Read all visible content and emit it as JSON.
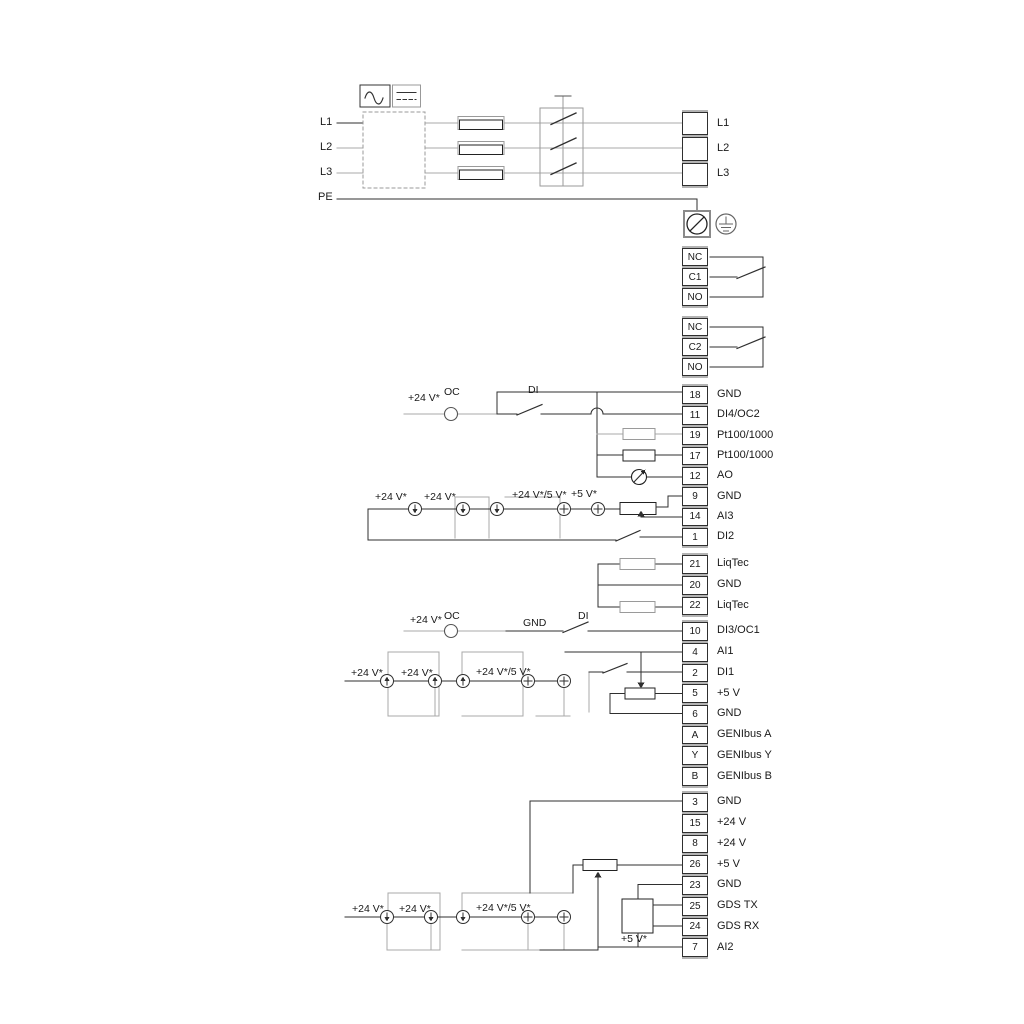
{
  "colors": {
    "wire_gray": "#a8a8a8",
    "wire_black": "#2f2f2f",
    "separator_gray": "#b3b3b3",
    "text": "#1a1a1a",
    "background": "#ffffff"
  },
  "power": {
    "inputs": [
      "L1",
      "L2",
      "L3",
      "PE"
    ]
  },
  "labels": {
    "p24": "+24 V*",
    "p24_5": "+24 V*/5 V*",
    "p5": "+5 V*",
    "oc": "OC",
    "di": "DI",
    "gnd": "GND"
  },
  "terminals": {
    "power_out": {
      "rows": [
        {
          "num": "",
          "label": "L1"
        },
        {
          "num": "",
          "label": "L2"
        },
        {
          "num": "",
          "label": "L3"
        }
      ]
    },
    "relay1": {
      "rows": [
        {
          "num": "NC",
          "label": ""
        },
        {
          "num": "C1",
          "label": ""
        },
        {
          "num": "NO",
          "label": ""
        }
      ]
    },
    "relay2": {
      "rows": [
        {
          "num": "NC",
          "label": ""
        },
        {
          "num": "C2",
          "label": ""
        },
        {
          "num": "NO",
          "label": ""
        }
      ]
    },
    "io1": {
      "rows": [
        {
          "num": "18",
          "label": "GND"
        },
        {
          "num": "11",
          "label": "DI4/OC2"
        },
        {
          "num": "19",
          "label": "Pt100/1000"
        },
        {
          "num": "17",
          "label": "Pt100/1000"
        },
        {
          "num": "12",
          "label": "AO"
        },
        {
          "num": "9",
          "label": "GND"
        },
        {
          "num": "14",
          "label": "AI3"
        },
        {
          "num": "1",
          "label": "DI2"
        }
      ]
    },
    "liqtec": {
      "rows": [
        {
          "num": "21",
          "label": "LiqTec"
        },
        {
          "num": "20",
          "label": "GND"
        },
        {
          "num": "22",
          "label": "LiqTec"
        }
      ]
    },
    "di3": {
      "rows": [
        {
          "num": "10",
          "label": "DI3/OC1"
        }
      ]
    },
    "io2": {
      "rows": [
        {
          "num": "4",
          "label": "AI1"
        },
        {
          "num": "2",
          "label": "DI1"
        },
        {
          "num": "5",
          "label": "+5 V"
        },
        {
          "num": "6",
          "label": "GND"
        },
        {
          "num": "A",
          "label": "GENIbus A"
        },
        {
          "num": "Y",
          "label": "GENIbus Y"
        },
        {
          "num": "B",
          "label": "GENIbus B"
        }
      ]
    },
    "io3": {
      "rows": [
        {
          "num": "3",
          "label": "GND"
        },
        {
          "num": "15",
          "label": "+24 V"
        },
        {
          "num": "8",
          "label": "+24 V"
        },
        {
          "num": "26",
          "label": "+5 V"
        },
        {
          "num": "23",
          "label": "GND"
        },
        {
          "num": "25",
          "label": "GDS TX"
        },
        {
          "num": "24",
          "label": "GDS RX"
        },
        {
          "num": "7",
          "label": "AI2"
        }
      ]
    }
  },
  "icons": {
    "ac_symbol": "sine-wave",
    "dc_symbol": "solid-dashed-line",
    "pe_screw_terminal": "circle-with-slash",
    "protective_earth": "earth-ground-symbol",
    "current_source": "circle-arrow",
    "voltage_source": "circle-plus",
    "potentiometer": "rect-with-wiper-arrow",
    "analog_output_meter": "circle-with-needle",
    "fuse": "double-rectangle",
    "switch_contact": "blade"
  }
}
